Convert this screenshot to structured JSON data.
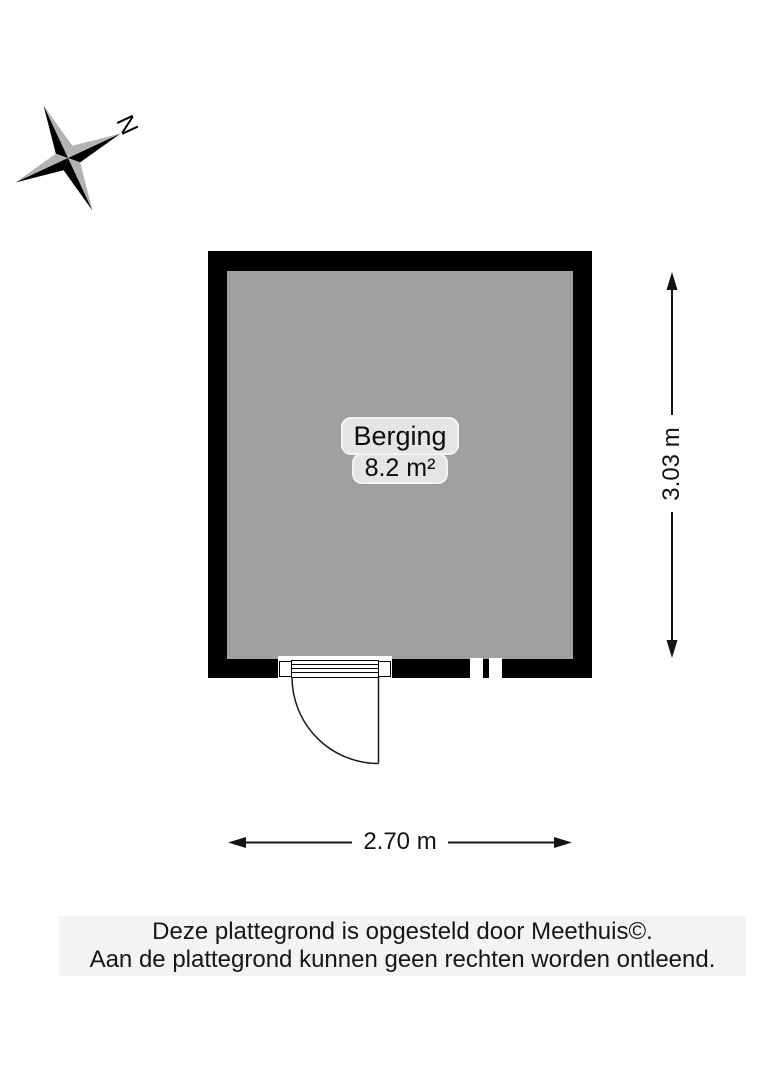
{
  "compass": {
    "north_label": "N"
  },
  "room": {
    "name": "Berging",
    "area": "8.2 m²"
  },
  "dimensions": {
    "height": "3.03 m",
    "width": "2.70 m"
  },
  "footer": {
    "line1": "Deze plattegrond is opgesteld door Meethuis©.",
    "line2": "Aan de plattegrond kunnen geen rechten worden ontleend."
  },
  "colors": {
    "wall": "#000000",
    "floor": "#a0a09e",
    "label_bg": "#e5e5e4",
    "footer_bg": "#f4f4f3",
    "star_gray": "#b3b3b3"
  }
}
